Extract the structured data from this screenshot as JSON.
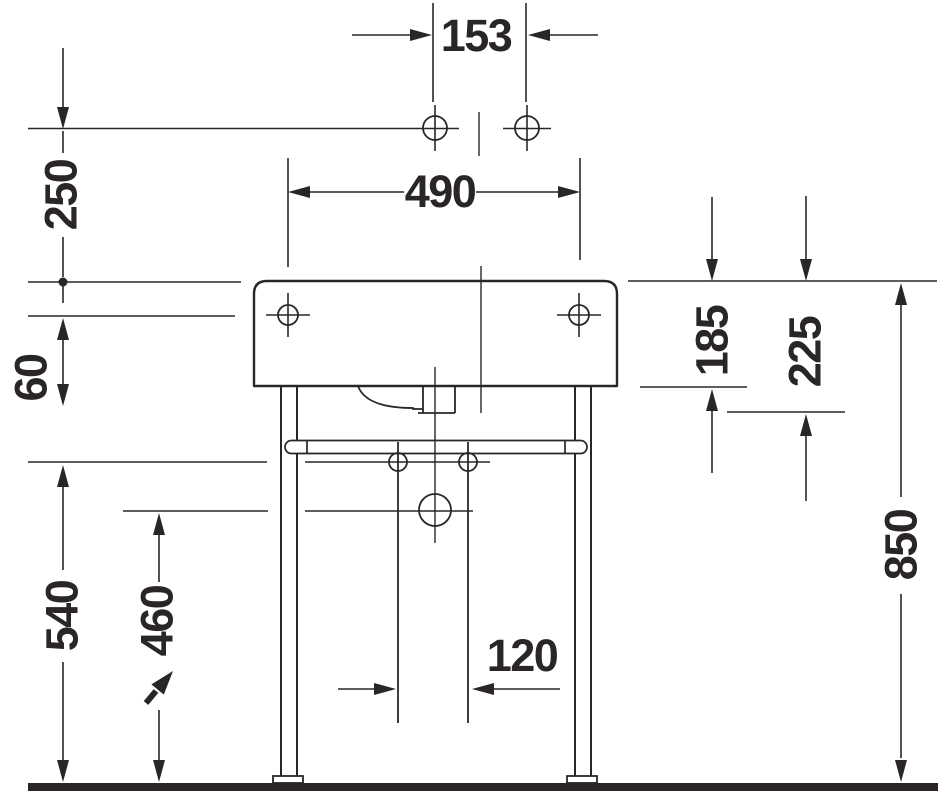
{
  "drawing": {
    "type": "technical-dimension-drawing",
    "subject": "washbasin-with-console-front-view"
  },
  "colors": {
    "ink": "#2a2627",
    "background": "#ffffff"
  },
  "dims": {
    "d153": "153",
    "d250": "250",
    "d490": "490",
    "d60": "60",
    "d185": "185",
    "d225": "225",
    "d850": "850",
    "d540": "540",
    "d460": "460",
    "d120": "120"
  }
}
